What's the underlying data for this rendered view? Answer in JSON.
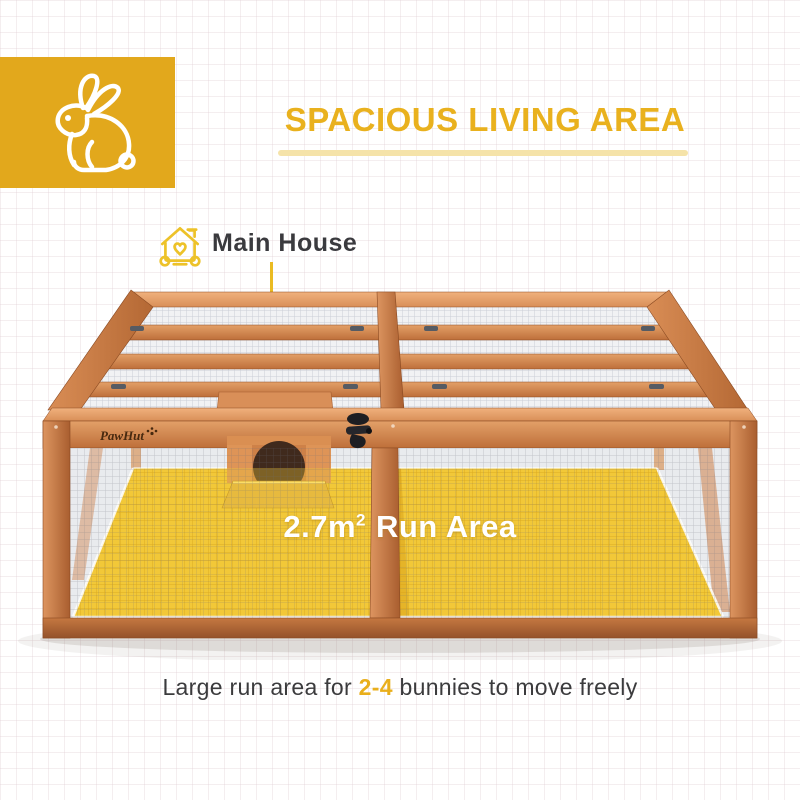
{
  "brand_badge": {
    "icon": "rabbit-icon",
    "bg_color": "#E2A81C"
  },
  "header": {
    "title": "SPACIOUS LIVING AREA",
    "title_color": "#E9B11E",
    "underline_color": "#F5E3A9"
  },
  "callout": {
    "icon": "house-heart-icon",
    "label": "Main House",
    "line_color": "#EABB22"
  },
  "product": {
    "brand_logo": "PawHut",
    "paw_icon": "paw-icon",
    "latch_icon": "latch-icon",
    "wood_color": "#CE8049",
    "floor_color": "#F2C838",
    "run_area": {
      "value": "2.7m",
      "sup": "2",
      "label": "Run Area"
    }
  },
  "caption": {
    "prefix": "Large run area for ",
    "highlight": "2-4",
    "suffix": " bunnies to move freely",
    "highlight_color": "#E9AF1C"
  }
}
